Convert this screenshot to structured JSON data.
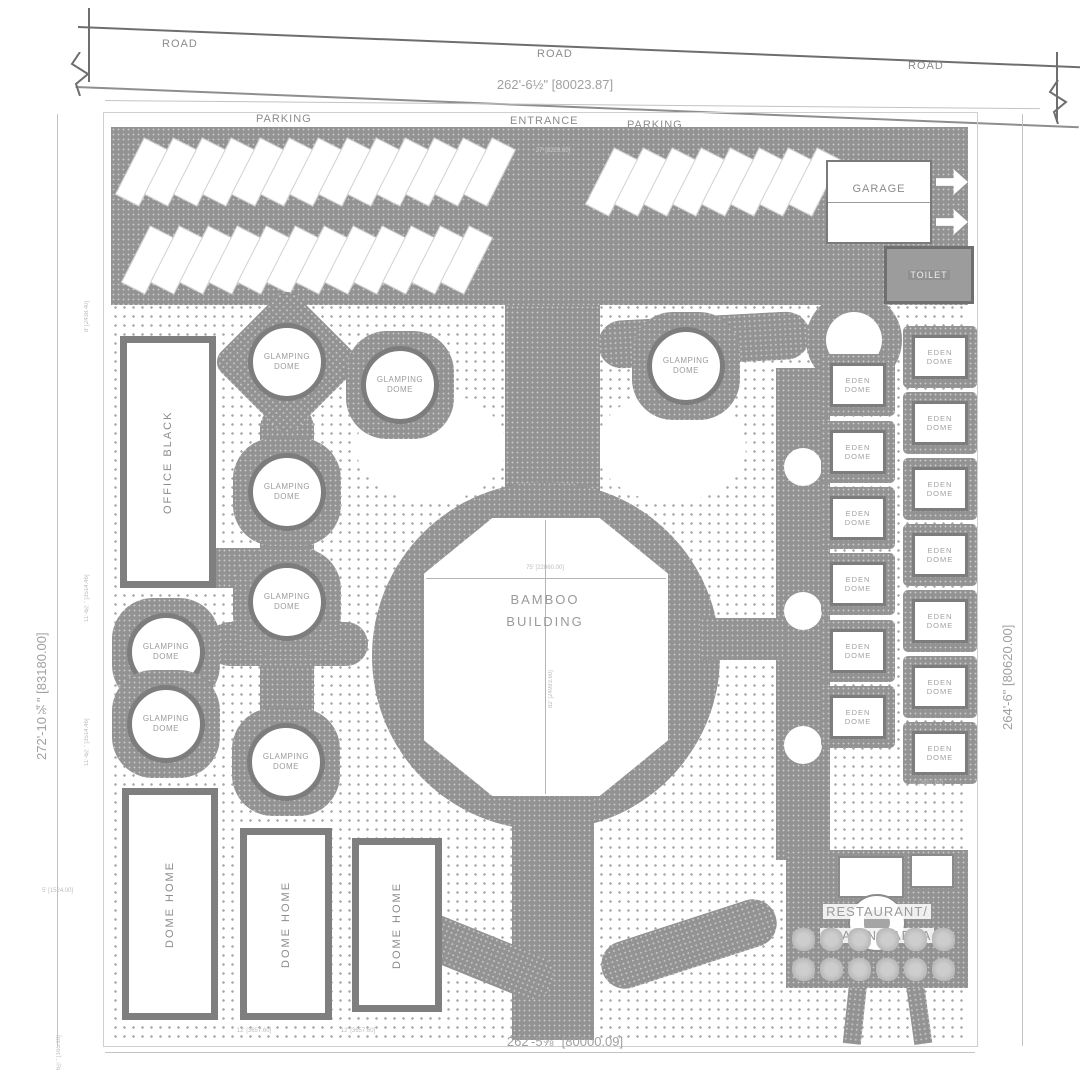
{
  "roads": [
    "ROAD",
    "ROAD",
    "ROAD"
  ],
  "dimensions": {
    "top": "262'-6½\" [80023.87]",
    "left": "272'-10¾\" [83180.00]",
    "right": "264'-6\" [80620.00]",
    "bottom": "262'-5⅝\" [80000.09]",
    "small": {
      "left_upper": "8' [2438.40]",
      "left_mid1": "11'-6⅞\" [3514.46]",
      "left_mid2": "11'-6⅞\" [3514.46]",
      "left_lower": "5' [1524.00]",
      "left_bottom": "6½\" [165.10]",
      "entrance": "27' [8229.60]",
      "bamboo_w": "75' [22860.00]",
      "bamboo_h": "82' [24993.60]",
      "dome_home_1": "12' [3657.60]",
      "dome_home_2": "12' [3657.60]",
      "eden_bottom": "12' [3657.60]"
    }
  },
  "site": {
    "parking_left": "PARKING",
    "entrance": "ENTRANCE",
    "parking_right": "PARKING",
    "garage": "GARAGE",
    "toilet": "TOILET",
    "office": "OFFICE BLACK",
    "bamboo_line1": "BAMBOO",
    "bamboo_line2": "BUILDING",
    "glamping_line1": "GLAMPING",
    "glamping_line2": "DOME",
    "eden_line1": "EDEN",
    "eden_line2": "DOME",
    "dome_home": "DOME HOME",
    "restaurant_line1": "RESTAURANT/",
    "restaurant_line2": "TRADING AREA"
  },
  "counts": {
    "parking_row1": 13,
    "parking_row2": 12,
    "parking_right": 8,
    "bushes_row": 6,
    "glamping_domes": 8,
    "eden_domes": 13,
    "dome_homes": 3
  }
}
